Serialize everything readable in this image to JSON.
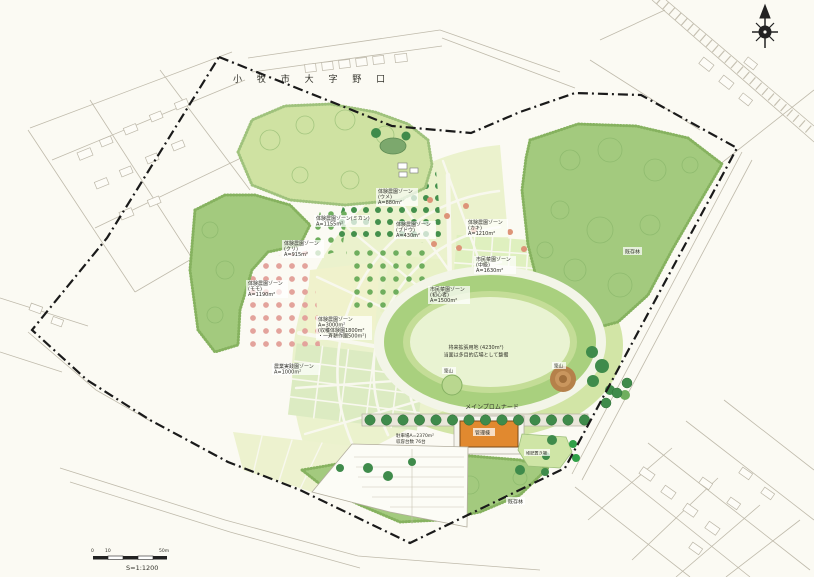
{
  "map": {
    "title": "小 牧 市 大 字 野 口",
    "scale_bar": {
      "tick_start": "0",
      "tick_mid": "10",
      "tick_end": "50m",
      "ratio": "S=1:1200"
    },
    "icons": {
      "north_compass": "compass-rose"
    },
    "zones": [
      {
        "lines": [
          "体験農園ゾーン",
          "(ウメ)",
          "A=880m²"
        ]
      },
      {
        "lines": [
          "体験農園ゾーン(ミカン)",
          "A=1155m²"
        ]
      },
      {
        "lines": [
          "体験農園ゾーン",
          "(ブドウ)",
          "A=430m²"
        ]
      },
      {
        "lines": [
          "体験農園ゾーン",
          "(クリ)",
          "A=915m²"
        ]
      },
      {
        "lines": [
          "体験農園ゾーン",
          "(カキ)",
          "A=1210m²"
        ]
      },
      {
        "lines": [
          "体験農園ゾーン",
          "(モモ)",
          "A=1190m²"
        ]
      },
      {
        "lines": [
          "市民菜園ゾーン",
          "(中級)",
          "A=1630m²"
        ]
      },
      {
        "lines": [
          "市民菜園ゾーン",
          "(初心者)",
          "A=1500m²"
        ]
      },
      {
        "lines": [
          "体験農園ゾーン",
          "A=3000m²",
          "(収穫体験園1800m²",
          "・一斉耕作園500m²)"
        ]
      },
      {
        "lines": [
          "農業実践園ゾーン",
          "A=1000m²"
        ]
      }
    ],
    "features": {
      "future_expansion": {
        "lines": [
          "将来拡張用地 (4230m²)",
          "当面は多目的広場として整備"
        ]
      },
      "mound_left": "築山",
      "mound_right": "築山",
      "promenade": "メインプロムナード",
      "admin_building": "管理棟",
      "parking": {
        "lines": [
          "駐車場A=2370m²",
          "収容台数  76台"
        ]
      },
      "compost": "堆肥置き場",
      "existing_forest_right": "既存林",
      "existing_forest_south": "既存林"
    },
    "colors": {
      "paper": "#fbfaf3",
      "forest_green": "#a3ca7e",
      "lawn_green": "#d2e5a6",
      "parcel_green": "#ebf2cd",
      "oval_ring_green": "#a9d07e",
      "oval_infield": "#e9f3d2",
      "tree_dark_green": "#3f8b4b",
      "blossom_pink": "#e3a39c",
      "building_orange": "#e1892f",
      "mound_brown": "#b5814a",
      "boundary_black": "#1a1a1a"
    }
  }
}
